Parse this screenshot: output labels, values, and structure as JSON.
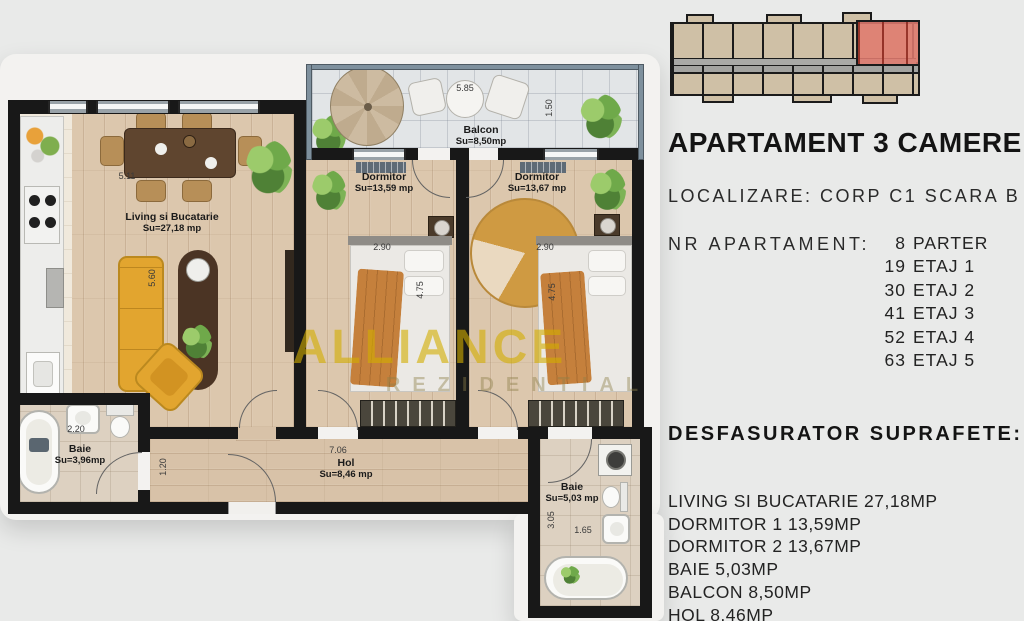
{
  "colors": {
    "background": "#e9eae9",
    "wall": "#181818",
    "wood_floor": "#dcc7ad",
    "balcony_tile": "#e2e5e7",
    "bath_tile": "#ddd1c1",
    "accent_furniture": "#e2a52f",
    "unit_highlight": "#e07a6e",
    "watermark_yellow": "#d3ae00"
  },
  "panel": {
    "title": "APARTAMENT 3 CAMERE",
    "localization": "LOCALIZARE: CORP C1 SCARA B",
    "nr_apartament_label": "NR APARTAMENT:",
    "apartments": [
      {
        "num": "8",
        "floor": "PARTER"
      },
      {
        "num": "19",
        "floor": "ETAJ 1"
      },
      {
        "num": "30",
        "floor": "ETAJ 2"
      },
      {
        "num": "41",
        "floor": "ETAJ 3"
      },
      {
        "num": "52",
        "floor": "ETAJ 4"
      },
      {
        "num": "63",
        "floor": "ETAJ 5"
      }
    ],
    "surfaces_title": "DESFASURATOR SUPRAFETE:",
    "surfaces": [
      "LIVING SI BUCATARIE 27,18MP",
      "DORMITOR 1 13,59MP",
      "DORMITOR 2 13,67MP",
      "BAIE 5,03MP",
      "BALCON 8,50MP",
      "HOL 8,46MP"
    ]
  },
  "plan": {
    "rooms": {
      "living": {
        "name": "Living si Bucatarie",
        "area": "Su=27,18 mp"
      },
      "dormitor1": {
        "name": "Dormitor",
        "area": "Su=13,59 mp"
      },
      "dormitor2": {
        "name": "Dormitor",
        "area": "Su=13,67 mp"
      },
      "balcon": {
        "name": "Balcon",
        "area": "Su=8,50mp"
      },
      "baie1": {
        "name": "Baie",
        "area": "Su=3,96mp"
      },
      "baie2": {
        "name": "Baie",
        "area": "Su=5,03 mp"
      },
      "hol": {
        "name": "Hol",
        "area": "Su=8,46 mp"
      }
    },
    "dimensions": {
      "balcon_width": "5.85",
      "balcon_depth": "1.50",
      "living_width": "5.11",
      "sofa_length": "5.60",
      "dormitor1_width": "2.90",
      "dormitor1_length": "4.75",
      "dormitor2_width": "2.90",
      "dormitor2_length": "4.75",
      "hol_width": "7.06",
      "hol_depth": "1.20",
      "baie1_width": "2.20",
      "baie2_depth": "3.05",
      "baie2_width": "1.65"
    }
  },
  "watermark": {
    "line1": "ALLIANCE",
    "line2": "REZIDENTIAL"
  }
}
